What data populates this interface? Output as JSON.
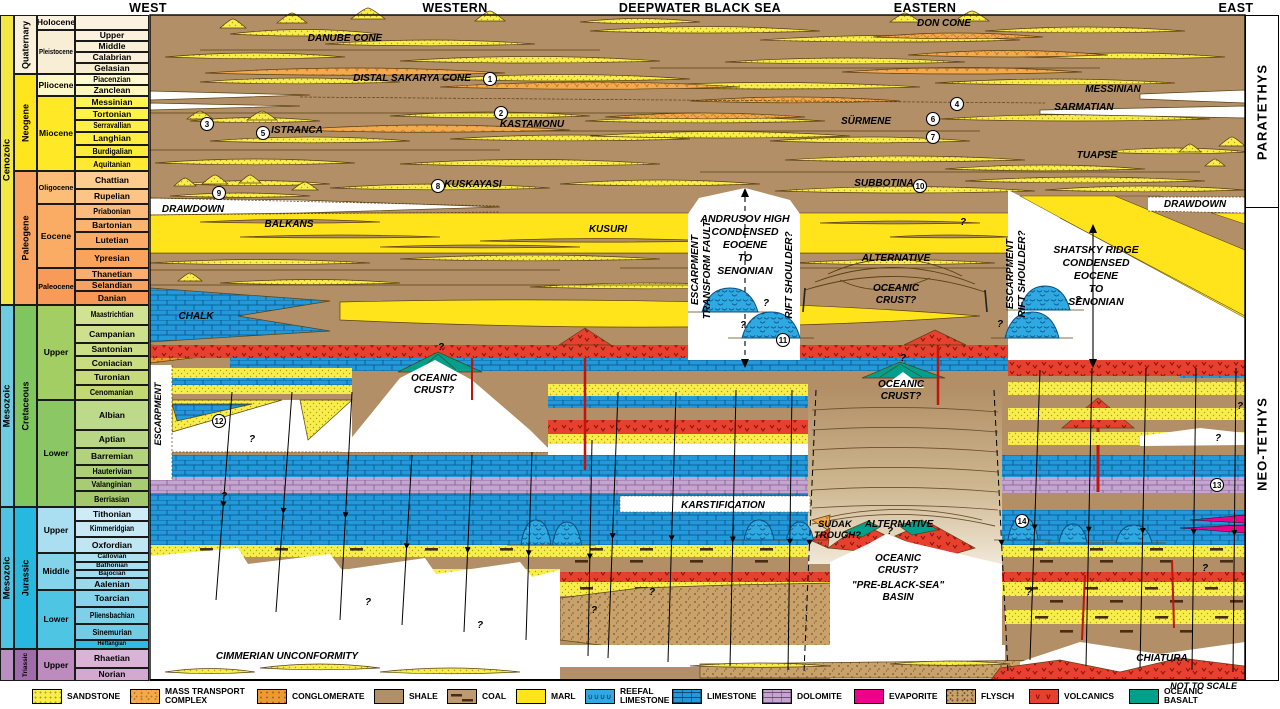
{
  "headers": {
    "items": [
      {
        "label": "WEST",
        "x": 148
      },
      {
        "label": "WESTERN",
        "x": 455
      },
      {
        "label": "DEEPWATER BLACK SEA",
        "x": 700
      },
      {
        "label": "EASTERN",
        "x": 925
      },
      {
        "label": "EAST",
        "x": 1236
      }
    ]
  },
  "tethys": {
    "paratethys": "PARATETHYS",
    "neotethys": "NEO-TETHYS",
    "divider_y": 207
  },
  "colors": {
    "shale": "#B28F66",
    "marl": "#FFE41C",
    "sandstone": "#F7EE4E",
    "sandstone_dot": "#B79D13",
    "mass_transport": "#F5A94E",
    "conglomerate": "#EE9A33",
    "limestone": "#2199DB",
    "reefal": "#2FA9E2",
    "dolomite": "#C5A5D0",
    "evaporite": "#EC008C",
    "flysch": "#C9A26B",
    "volcanics": "#E8402F",
    "volcanics_dark": "#7E120C",
    "oceanic_basalt": "#00A08C",
    "coal": "#4A2C12",
    "outline": "#5A4010"
  },
  "timescale": {
    "eras": [
      {
        "label": "Cenozoic",
        "y": 15,
        "h": 290,
        "color": "#F2E843"
      },
      {
        "label": "Mesozoic",
        "y": 305,
        "h": 202,
        "color": "#6FCBE0"
      },
      {
        "label": "Mesozoic",
        "y": 507,
        "h": 142,
        "color": "#4FC3E4"
      },
      {
        "label": "",
        "y": 649,
        "h": 32,
        "color": "#B98FC2"
      }
    ],
    "periods": [
      {
        "label": "Quaternary",
        "y": 15,
        "h": 59,
        "color": "#FAF0DC"
      },
      {
        "label": "Neogene",
        "y": 74,
        "h": 97,
        "color": "#FFE51E"
      },
      {
        "label": "Paleogene",
        "y": 171,
        "h": 134,
        "color": "#F9A460"
      },
      {
        "label": "Cretaceous",
        "y": 305,
        "h": 202,
        "color": "#80C660"
      },
      {
        "label": "Jurassic",
        "y": 507,
        "h": 142,
        "color": "#27B8E0"
      },
      {
        "label": "Triassic",
        "y": 649,
        "h": 32,
        "color": "#A06BAB"
      }
    ],
    "epochs": [
      {
        "label": "Holocene",
        "y": 15,
        "h": 15,
        "color": "#FBF2DF"
      },
      {
        "label": "Pleistocene",
        "y": 30,
        "h": 44,
        "color": "#F8EED6"
      },
      {
        "label": "Pliocene",
        "y": 74,
        "h": 22,
        "color": "#FEF8C9"
      },
      {
        "label": "Miocene",
        "y": 96,
        "h": 75,
        "color": "#FFE926"
      },
      {
        "label": "Oligocene",
        "y": 171,
        "h": 33,
        "color": "#FCBE77"
      },
      {
        "label": "Eocene",
        "y": 204,
        "h": 64,
        "color": "#FAAC64"
      },
      {
        "label": "Paleocene",
        "y": 268,
        "h": 37,
        "color": "#F89B58"
      },
      {
        "label": "Upper",
        "y": 305,
        "h": 95,
        "color": "#A3CE63"
      },
      {
        "label": "Lower",
        "y": 400,
        "h": 107,
        "color": "#8CC765"
      },
      {
        "label": "Upper",
        "y": 507,
        "h": 46,
        "color": "#A9DFF0"
      },
      {
        "label": "Middle",
        "y": 553,
        "h": 37,
        "color": "#83D3EA"
      },
      {
        "label": "Lower",
        "y": 590,
        "h": 59,
        "color": "#4FC5E4"
      },
      {
        "label": "Upper",
        "y": 649,
        "h": 32,
        "color": "#BE8BBE"
      }
    ],
    "stages": [
      {
        "label": "",
        "y": 15,
        "h": 15,
        "color": "#FBF2DF"
      },
      {
        "label": "Upper",
        "y": 30,
        "h": 11,
        "color": "#FBF1DC"
      },
      {
        "label": "Middle",
        "y": 41,
        "h": 11,
        "color": "#FAF0D6"
      },
      {
        "label": "Calabrian",
        "y": 52,
        "h": 11,
        "color": "#FAEFDA"
      },
      {
        "label": "Gelasian",
        "y": 63,
        "h": 11,
        "color": "#F7EDD0"
      },
      {
        "label": "Piacenzian",
        "y": 74,
        "h": 11,
        "color": "#FFFACF"
      },
      {
        "label": "Zanclean",
        "y": 85,
        "h": 11,
        "color": "#FEF7BC"
      },
      {
        "label": "Messinian",
        "y": 96,
        "h": 12,
        "color": "#FFF451"
      },
      {
        "label": "Tortonian",
        "y": 108,
        "h": 12,
        "color": "#FFF24B"
      },
      {
        "label": "Serravallian",
        "y": 120,
        "h": 12,
        "color": "#FFF045"
      },
      {
        "label": "Langhian",
        "y": 132,
        "h": 13,
        "color": "#FFEE3F"
      },
      {
        "label": "Burdigalian",
        "y": 145,
        "h": 12,
        "color": "#FFEB39"
      },
      {
        "label": "Aquitanian",
        "y": 157,
        "h": 14,
        "color": "#FFE933"
      },
      {
        "label": "Chattian",
        "y": 171,
        "h": 18,
        "color": "#FDCC8E"
      },
      {
        "label": "Rupelian",
        "y": 189,
        "h": 15,
        "color": "#FCC485"
      },
      {
        "label": "Priabonian",
        "y": 204,
        "h": 15,
        "color": "#FCBB7D"
      },
      {
        "label": "Bartonian",
        "y": 219,
        "h": 13,
        "color": "#FBB372"
      },
      {
        "label": "Lutetian",
        "y": 232,
        "h": 17,
        "color": "#FAAB67"
      },
      {
        "label": "Ypresian",
        "y": 249,
        "h": 19,
        "color": "#F9A35C"
      },
      {
        "label": "Thanetian",
        "y": 268,
        "h": 12,
        "color": "#FAAD6C"
      },
      {
        "label": "Selandian",
        "y": 280,
        "h": 11,
        "color": "#F9A160"
      },
      {
        "label": "Danian",
        "y": 291,
        "h": 14,
        "color": "#F99756"
      },
      {
        "label": "Maastrichtian",
        "y": 305,
        "h": 20,
        "color": "#D2E294"
      },
      {
        "label": "Campanian",
        "y": 325,
        "h": 18,
        "color": "#CFE08D"
      },
      {
        "label": "Santonian",
        "y": 343,
        "h": 13,
        "color": "#CCDE86"
      },
      {
        "label": "Coniacian",
        "y": 356,
        "h": 14,
        "color": "#C9DC80"
      },
      {
        "label": "Turonian",
        "y": 370,
        "h": 15,
        "color": "#C6DA7A"
      },
      {
        "label": "Cenomanian",
        "y": 385,
        "h": 15,
        "color": "#C3D873"
      },
      {
        "label": "Albian",
        "y": 400,
        "h": 30,
        "color": "#BDDA8A"
      },
      {
        "label": "Aptian",
        "y": 430,
        "h": 18,
        "color": "#B8D685"
      },
      {
        "label": "Barremian",
        "y": 448,
        "h": 17,
        "color": "#B2D27E"
      },
      {
        "label": "Hauterivian",
        "y": 465,
        "h": 13,
        "color": "#ADCF78"
      },
      {
        "label": "Valanginian",
        "y": 478,
        "h": 13,
        "color": "#A8CC72"
      },
      {
        "label": "Berriasian",
        "y": 491,
        "h": 16,
        "color": "#A3C96C"
      },
      {
        "label": "Tithonian",
        "y": 507,
        "h": 14,
        "color": "#CEECF7"
      },
      {
        "label": "Kimmeridgian",
        "y": 521,
        "h": 16,
        "color": "#C6E9F5"
      },
      {
        "label": "Oxfordian",
        "y": 537,
        "h": 16,
        "color": "#BEE6F3"
      },
      {
        "label": "Callovian",
        "y": 553,
        "h": 9,
        "color": "#ADE1F2"
      },
      {
        "label": "Bathonian",
        "y": 562,
        "h": 8,
        "color": "#A7DEF0"
      },
      {
        "label": "Bajocian",
        "y": 570,
        "h": 8,
        "color": "#A1DBEE"
      },
      {
        "label": "Aalenian",
        "y": 578,
        "h": 12,
        "color": "#9BD8EC"
      },
      {
        "label": "Toarcian",
        "y": 590,
        "h": 17,
        "color": "#87D3EA"
      },
      {
        "label": "Pliensbachian",
        "y": 607,
        "h": 17,
        "color": "#7ECFE8"
      },
      {
        "label": "Sinemurian",
        "y": 624,
        "h": 16,
        "color": "#74CBE6"
      },
      {
        "label": "Hettangian",
        "y": 640,
        "h": 9,
        "color": "#2FBCE0"
      },
      {
        "label": "Rhaetian",
        "y": 649,
        "h": 19,
        "color": "#DAB4D7"
      },
      {
        "label": "Norian",
        "y": 668,
        "h": 13,
        "color": "#D4A9D1"
      }
    ]
  },
  "panel_labels": [
    {
      "t": "DANUBE CONE",
      "x": 345,
      "y": 41
    },
    {
      "t": "DON CONE",
      "x": 944,
      "y": 26
    },
    {
      "t": "DISTAL SAKARYA CONE",
      "x": 412,
      "y": 81
    },
    {
      "t": "MESSINIAN",
      "x": 1113,
      "y": 92
    },
    {
      "t": "SARMATIAN",
      "x": 1084,
      "y": 110
    },
    {
      "t": "KASTAMONU",
      "x": 532,
      "y": 127
    },
    {
      "t": "ISTRANCA",
      "x": 297,
      "y": 133
    },
    {
      "t": "SÜRMENE",
      "x": 866,
      "y": 124
    },
    {
      "t": "TUAPSE",
      "x": 1097,
      "y": 158
    },
    {
      "t": "KUSKAYASI",
      "x": 473,
      "y": 187
    },
    {
      "t": "SUBBOTINA",
      "x": 884,
      "y": 186
    },
    {
      "t": "DRAWDOWN",
      "x": 193,
      "y": 212
    },
    {
      "t": "DRAWDOWN",
      "x": 1195,
      "y": 207
    },
    {
      "t": "BALKANS",
      "x": 289,
      "y": 227
    },
    {
      "t": "KUSURI",
      "x": 608,
      "y": 232
    },
    {
      "t": "ANDRUSOV HIGH",
      "x": 745,
      "y": 222,
      "s": 10.5
    },
    {
      "t": "CONDENSED",
      "x": 745,
      "y": 235,
      "s": 10.5
    },
    {
      "t": "EOCENE",
      "x": 745,
      "y": 248,
      "s": 10.5
    },
    {
      "t": "TO",
      "x": 745,
      "y": 261,
      "s": 10.5
    },
    {
      "t": "SENONIAN",
      "x": 745,
      "y": 274,
      "s": 10.5
    },
    {
      "t": "ESCARPMENT",
      "x": 698,
      "y": 270,
      "r": -90
    },
    {
      "t": "TRANSFORM FAULT",
      "x": 710,
      "y": 270,
      "r": -90
    },
    {
      "t": "RIFT SHOULDER?",
      "x": 792,
      "y": 275,
      "r": -90
    },
    {
      "t": "ALTERNATIVE",
      "x": 896,
      "y": 261
    },
    {
      "t": "OCEANIC",
      "x": 896,
      "y": 291
    },
    {
      "t": "CRUST?",
      "x": 896,
      "y": 303
    },
    {
      "t": "CHALK",
      "x": 196,
      "y": 319
    },
    {
      "t": "OCEANIC",
      "x": 434,
      "y": 381
    },
    {
      "t": "CRUST?",
      "x": 434,
      "y": 393
    },
    {
      "t": "OCEANIC",
      "x": 901,
      "y": 387
    },
    {
      "t": "CRUST?",
      "x": 901,
      "y": 399
    },
    {
      "t": "ESCARPMENT",
      "x": 1013,
      "y": 274,
      "r": -90
    },
    {
      "t": "RIFT SHOULDER?",
      "x": 1025,
      "y": 274,
      "r": -90
    },
    {
      "t": "SHATSKY RIDGE",
      "x": 1096,
      "y": 253,
      "s": 10.5
    },
    {
      "t": "CONDENSED",
      "x": 1096,
      "y": 266,
      "s": 10.5
    },
    {
      "t": "EOCENE",
      "x": 1096,
      "y": 279,
      "s": 10.5
    },
    {
      "t": "TO",
      "x": 1096,
      "y": 292,
      "s": 10.5
    },
    {
      "t": "SENONIAN",
      "x": 1096,
      "y": 305,
      "s": 10.5
    },
    {
      "t": "ESCARPMENT",
      "x": 161,
      "y": 414,
      "r": -90,
      "s": 9
    },
    {
      "t": "KARSTIFICATION",
      "x": 723,
      "y": 508
    },
    {
      "t": "SUDAK",
      "x": 818,
      "y": 527,
      "a": "start",
      "s": 9.5
    },
    {
      "t": "TROUGH?",
      "x": 814,
      "y": 538,
      "a": "start",
      "s": 9.5
    },
    {
      "t": "ALTERNATIVE",
      "x": 899,
      "y": 527
    },
    {
      "t": "OCEANIC",
      "x": 898,
      "y": 561
    },
    {
      "t": "CRUST?",
      "x": 898,
      "y": 573
    },
    {
      "t": "\"PRE-BLACK-SEA\"",
      "x": 898,
      "y": 588
    },
    {
      "t": "BASIN",
      "x": 898,
      "y": 600
    },
    {
      "t": "CIMMERIAN UNCONFORMITY",
      "x": 287,
      "y": 659
    },
    {
      "t": "CHIATURA",
      "x": 1162,
      "y": 661
    }
  ],
  "markers": [
    {
      "n": "1",
      "x": 490,
      "y": 79
    },
    {
      "n": "2",
      "x": 501,
      "y": 113
    },
    {
      "n": "3",
      "x": 207,
      "y": 124
    },
    {
      "n": "4",
      "x": 957,
      "y": 104
    },
    {
      "n": "5",
      "x": 263,
      "y": 133
    },
    {
      "n": "6",
      "x": 933,
      "y": 119
    },
    {
      "n": "7",
      "x": 933,
      "y": 137
    },
    {
      "n": "8",
      "x": 438,
      "y": 186
    },
    {
      "n": "9",
      "x": 219,
      "y": 193
    },
    {
      "n": "10",
      "x": 920,
      "y": 186
    },
    {
      "n": "11",
      "x": 783,
      "y": 340
    },
    {
      "n": "12",
      "x": 219,
      "y": 421
    },
    {
      "n": "13",
      "x": 1217,
      "y": 485
    },
    {
      "n": "14",
      "x": 1022,
      "y": 521
    }
  ],
  "question_mark": "?",
  "question_marks": [
    [
      963,
      225
    ],
    [
      766,
      306
    ],
    [
      743,
      328
    ],
    [
      1078,
      303
    ],
    [
      1000,
      327
    ],
    [
      252,
      442
    ],
    [
      224,
      499
    ],
    [
      480,
      628
    ],
    [
      594,
      613
    ],
    [
      652,
      595
    ],
    [
      1029,
      595
    ],
    [
      1205,
      571
    ],
    [
      903,
      361
    ],
    [
      1218,
      441
    ],
    [
      368,
      605
    ],
    [
      890,
      534
    ],
    [
      1240,
      409
    ],
    [
      441,
      350
    ]
  ],
  "legend": {
    "not_to_scale": "NOT TO SCALE",
    "items": [
      {
        "lines": [
          "SANDSTONE"
        ],
        "type": "sandstone",
        "x": 32
      },
      {
        "lines": [
          "MASS TRANSPORT",
          "COMPLEX"
        ],
        "type": "mtc",
        "x": 130
      },
      {
        "lines": [
          "CONGLOMERATE"
        ],
        "type": "conglomerate",
        "x": 257
      },
      {
        "lines": [
          "SHALE"
        ],
        "type": "shale",
        "x": 374
      },
      {
        "lines": [
          "COAL"
        ],
        "type": "coal",
        "x": 447
      },
      {
        "lines": [
          "MARL"
        ],
        "type": "marl",
        "x": 516
      },
      {
        "lines": [
          "REEFAL",
          "LIMESTONE"
        ],
        "type": "reefal",
        "x": 585
      },
      {
        "lines": [
          "LIMESTONE"
        ],
        "type": "limestone",
        "x": 672
      },
      {
        "lines": [
          "DOLOMITE"
        ],
        "type": "dolomite",
        "x": 762
      },
      {
        "lines": [
          "EVAPORITE"
        ],
        "type": "evaporite",
        "x": 854
      },
      {
        "lines": [
          "FLYSCH"
        ],
        "type": "flysch",
        "x": 946
      },
      {
        "lines": [
          "VOLCANICS"
        ],
        "type": "volcanics",
        "x": 1029
      },
      {
        "lines": [
          "OCEANIC",
          "BASALT"
        ],
        "type": "oceanic-basalt",
        "x": 1129
      }
    ]
  }
}
